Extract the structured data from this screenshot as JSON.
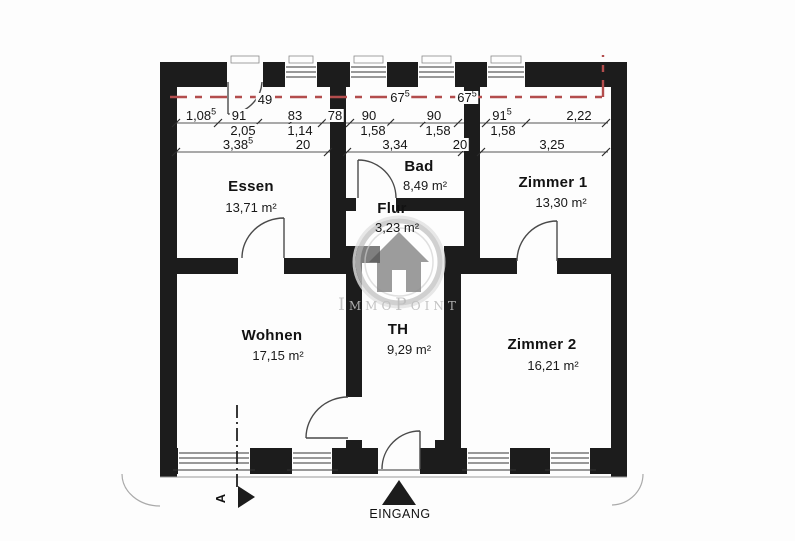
{
  "plan": {
    "type": "floor-plan",
    "rooms": [
      {
        "name": "Essen",
        "area": "13,71 m²"
      },
      {
        "name": "Bad",
        "area": "8,49 m²"
      },
      {
        "name": "Flur",
        "area": "3,23 m²"
      },
      {
        "name": "Zimmer 1",
        "area": "13,30 m²"
      },
      {
        "name": "Wohnen",
        "area": "17,15 m²"
      },
      {
        "name": "TH",
        "area": "9,29 m²"
      },
      {
        "name": "Zimmer 2",
        "area": "16,21 m²"
      }
    ],
    "dimensions": {
      "row_window": [
        {
          "text": "49",
          "sup": ""
        },
        {
          "text": "67",
          "sup": "5"
        },
        {
          "text": "67",
          "sup": "5"
        }
      ],
      "row_detail": [
        {
          "text": "1,08",
          "sup": "5"
        },
        {
          "text": "91",
          "sup": ""
        },
        {
          "text": "83",
          "sup": ""
        },
        {
          "text": "78",
          "sup": ""
        },
        {
          "text": "90",
          "sup": ""
        },
        {
          "text": "90",
          "sup": ""
        },
        {
          "text": "91",
          "sup": "5"
        },
        {
          "text": "2,22",
          "sup": ""
        }
      ],
      "row_mid": [
        {
          "text": "2,05",
          "sup": ""
        },
        {
          "text": "1,14",
          "sup": ""
        },
        {
          "text": "1,58",
          "sup": ""
        },
        {
          "text": "1,58",
          "sup": ""
        },
        {
          "text": "1,58",
          "sup": ""
        }
      ],
      "row_total": [
        {
          "text": "3,38",
          "sup": "5"
        },
        {
          "text": "20",
          "sup": ""
        },
        {
          "text": "3,34",
          "sup": ""
        },
        {
          "text": "20",
          "sup": ""
        },
        {
          "text": "3,25",
          "sup": ""
        }
      ]
    },
    "labels": {
      "entrance": "EINGANG",
      "section": "A"
    },
    "watermark": "ImmoPoint",
    "colors": {
      "wall": "#1c1c1c",
      "red_dash_line": "#b34d4d",
      "dimension_line": "#555555",
      "watermark_gray": "#bdbdbd"
    }
  }
}
